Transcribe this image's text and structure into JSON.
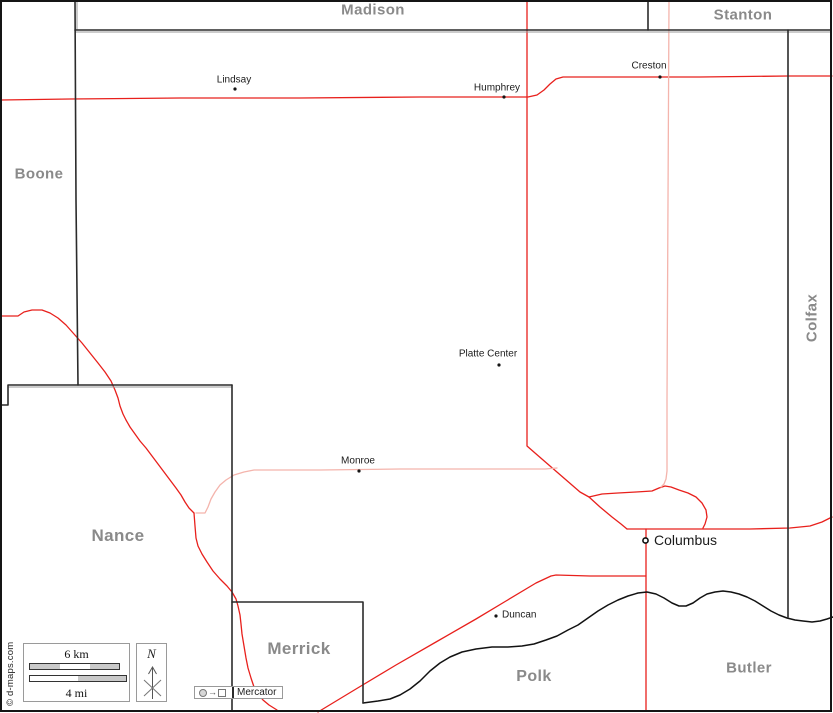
{
  "map": {
    "width": 833,
    "height": 713,
    "colors": {
      "background": "#ffffff",
      "frame": "#151515",
      "boundary": "#2b2b2b",
      "boundary_shadow": "#9a9a9a",
      "road_red": "#e8201c",
      "road_pink": "#f4b4ac",
      "river": "#121212",
      "county_label": "#8a8a8a",
      "town_label": "#1b1b1b"
    }
  },
  "counties": [
    {
      "name": "Madison",
      "pos": [
        373,
        10
      ],
      "size": 15,
      "rotate": false
    },
    {
      "name": "Stanton",
      "pos": [
        743,
        15
      ],
      "size": 15,
      "rotate": false
    },
    {
      "name": "Boone",
      "pos": [
        39,
        174
      ],
      "size": 15,
      "rotate": false
    },
    {
      "name": "Colfax",
      "pos": [
        812,
        318
      ],
      "size": 15,
      "rotate": true
    },
    {
      "name": "Nance",
      "pos": [
        118,
        536
      ],
      "size": 17,
      "rotate": false
    },
    {
      "name": "Merrick",
      "pos": [
        299,
        649
      ],
      "size": 17,
      "rotate": false
    },
    {
      "name": "Polk",
      "pos": [
        534,
        677
      ],
      "size": 16,
      "rotate": false
    },
    {
      "name": "Butler",
      "pos": [
        749,
        668
      ],
      "size": 15,
      "rotate": false
    }
  ],
  "towns": [
    {
      "name": "Lindsay",
      "dot": [
        235,
        89
      ],
      "label": [
        234,
        80
      ],
      "anchor": "center",
      "major": false
    },
    {
      "name": "Humphrey",
      "dot": [
        504,
        97
      ],
      "label": [
        497,
        88
      ],
      "anchor": "center",
      "major": false
    },
    {
      "name": "Creston",
      "dot": [
        660,
        77
      ],
      "label": [
        649,
        66
      ],
      "anchor": "center",
      "major": false
    },
    {
      "name": "Platte Center",
      "dot": [
        499,
        365
      ],
      "label": [
        488,
        354
      ],
      "anchor": "center",
      "major": false
    },
    {
      "name": "Monroe",
      "dot": [
        359,
        471
      ],
      "label": [
        358,
        461
      ],
      "anchor": "center",
      "major": false
    },
    {
      "name": "Duncan",
      "dot": [
        496,
        616
      ],
      "label": [
        502,
        615
      ],
      "anchor": "left",
      "major": false
    },
    {
      "name": "Columbus",
      "dot": [
        645.5,
        540.5
      ],
      "label": [
        654,
        540
      ],
      "anchor": "left",
      "major": true
    }
  ],
  "legend": {
    "scale_km": "6 km",
    "scale_mi": "4 mi",
    "north_label": "N",
    "projection": "Mercator",
    "copyright": "© d-maps.com"
  },
  "geometry": {
    "frame": {
      "x": 1,
      "y": 1,
      "w": 830,
      "h": 710
    },
    "boundaries": [
      {
        "name": "boundary-boone-east",
        "points": [
          [
            75,
            1
          ],
          [
            76,
            200
          ],
          [
            78,
            385
          ]
        ]
      },
      {
        "name": "boundary-platte-north",
        "points": [
          [
            75,
            30
          ],
          [
            831,
            30
          ]
        ]
      },
      {
        "name": "boundary-madison-stanton",
        "points": [
          [
            648,
            1
          ],
          [
            648,
            30
          ]
        ]
      },
      {
        "name": "boundary-colfax-west",
        "points": [
          [
            788,
            30
          ],
          [
            788,
            617
          ]
        ]
      },
      {
        "name": "boundary-nance-north",
        "points": [
          [
            232,
            385
          ],
          [
            8,
            385
          ],
          [
            8,
            405
          ],
          [
            1,
            405
          ]
        ]
      },
      {
        "name": "boundary-nance-east",
        "points": [
          [
            232,
            385
          ],
          [
            232,
            711
          ]
        ]
      },
      {
        "name": "boundary-merrick-box",
        "points": [
          [
            232,
            602
          ],
          [
            363,
            602
          ],
          [
            363,
            703
          ]
        ]
      }
    ],
    "boundary_shadows": [
      {
        "name": "shadow-boone-east",
        "points": [
          [
            77,
            2
          ],
          [
            77,
            29
          ]
        ]
      },
      {
        "name": "shadow-platte-north",
        "points": [
          [
            76,
            32
          ],
          [
            831,
            32
          ]
        ]
      },
      {
        "name": "shadow-nance-north",
        "points": [
          [
            9,
            387
          ],
          [
            232,
            387
          ]
        ]
      }
    ],
    "river": {
      "name": "river",
      "points": [
        [
          363,
          703
        ],
        [
          378,
          701
        ],
        [
          390,
          699
        ],
        [
          400,
          695
        ],
        [
          410,
          689
        ],
        [
          420,
          681
        ],
        [
          430,
          671
        ],
        [
          440,
          663
        ],
        [
          450,
          657
        ],
        [
          462,
          652
        ],
        [
          476,
          649
        ],
        [
          492,
          647
        ],
        [
          508,
          647
        ],
        [
          522,
          646
        ],
        [
          534,
          644
        ],
        [
          546,
          640
        ],
        [
          557,
          636
        ],
        [
          568,
          630
        ],
        [
          578,
          625
        ],
        [
          588,
          618
        ],
        [
          598,
          611
        ],
        [
          608,
          605
        ],
        [
          618,
          600
        ],
        [
          628,
          596
        ],
        [
          638,
          593
        ],
        [
          647,
          592
        ],
        [
          656,
          594
        ],
        [
          664,
          598
        ],
        [
          672,
          603
        ],
        [
          679,
          606
        ],
        [
          686,
          606
        ],
        [
          693,
          603
        ],
        [
          700,
          598
        ],
        [
          707,
          594
        ],
        [
          715,
          592
        ],
        [
          723,
          591
        ],
        [
          731,
          592
        ],
        [
          739,
          594
        ],
        [
          747,
          597
        ],
        [
          755,
          601
        ],
        [
          763,
          606
        ],
        [
          771,
          611
        ],
        [
          779,
          615
        ],
        [
          787,
          618
        ],
        [
          795,
          620
        ],
        [
          803,
          621
        ],
        [
          812,
          622
        ],
        [
          820,
          621
        ],
        [
          827,
          619
        ],
        [
          833,
          617
        ]
      ]
    },
    "roads": [
      {
        "name": "road-north-highway",
        "tone": "red",
        "points": [
          [
            1,
            100
          ],
          [
            70,
            99
          ],
          [
            180,
            98
          ],
          [
            300,
            98
          ],
          [
            420,
            97
          ],
          [
            500,
            97
          ],
          [
            528,
            97
          ],
          [
            537,
            95
          ],
          [
            544,
            90
          ],
          [
            550,
            84
          ],
          [
            556,
            79
          ],
          [
            563,
            77
          ],
          [
            620,
            77
          ],
          [
            700,
            77
          ],
          [
            788,
            76
          ],
          [
            832,
            76
          ]
        ]
      },
      {
        "name": "road-humphrey-columbus",
        "tone": "red",
        "points": [
          [
            527,
            1
          ],
          [
            527,
            150
          ],
          [
            527,
            300
          ],
          [
            527,
            446
          ],
          [
            535,
            453
          ],
          [
            550,
            466
          ],
          [
            565,
            479
          ],
          [
            580,
            492
          ],
          [
            589,
            497
          ],
          [
            600,
            507
          ],
          [
            612,
            517
          ],
          [
            621,
            524
          ],
          [
            627,
            529
          ]
        ]
      },
      {
        "name": "road-loop-north-columbus",
        "tone": "red",
        "points": [
          [
            589,
            497
          ],
          [
            602,
            494
          ],
          [
            618,
            493
          ],
          [
            636,
            492
          ],
          [
            652,
            491
          ],
          [
            659,
            488
          ],
          [
            665,
            486
          ],
          [
            671,
            487
          ],
          [
            679,
            490
          ],
          [
            688,
            493
          ],
          [
            696,
            497
          ],
          [
            702,
            503
          ],
          [
            706,
            510
          ],
          [
            707,
            517
          ],
          [
            705,
            524
          ],
          [
            703,
            528
          ]
        ]
      },
      {
        "name": "road-columbus-east",
        "tone": "red",
        "points": [
          [
            627,
            529
          ],
          [
            665,
            529
          ],
          [
            705,
            529
          ],
          [
            750,
            529
          ],
          [
            790,
            528
          ],
          [
            810,
            526
          ],
          [
            822,
            522
          ],
          [
            832,
            517
          ]
        ]
      },
      {
        "name": "road-columbus-south",
        "tone": "red",
        "points": [
          [
            646,
            529
          ],
          [
            646,
            570
          ],
          [
            646,
            592
          ],
          [
            646,
            650
          ],
          [
            646,
            711
          ]
        ]
      },
      {
        "name": "road-duncan",
        "tone": "red",
        "points": [
          [
            318,
            712
          ],
          [
            356,
            689
          ],
          [
            396,
            665
          ],
          [
            436,
            642
          ],
          [
            476,
            619
          ],
          [
            506,
            601
          ],
          [
            536,
            583
          ],
          [
            551,
            576
          ],
          [
            556,
            575
          ],
          [
            590,
            576
          ],
          [
            620,
            576
          ],
          [
            646,
            576
          ]
        ]
      },
      {
        "name": "road-northwest",
        "tone": "red",
        "points": [
          [
            0,
            316
          ],
          [
            18,
            316
          ],
          [
            24,
            312
          ],
          [
            32,
            310
          ],
          [
            42,
            310
          ],
          [
            50,
            313
          ],
          [
            58,
            318
          ],
          [
            66,
            325
          ],
          [
            74,
            334
          ],
          [
            82,
            343
          ],
          [
            90,
            353
          ],
          [
            98,
            363
          ],
          [
            105,
            372
          ],
          [
            111,
            381
          ],
          [
            115,
            390
          ],
          [
            118,
            398
          ],
          [
            120,
            406
          ],
          [
            123,
            414
          ],
          [
            126,
            420
          ],
          [
            130,
            427
          ],
          [
            135,
            434
          ],
          [
            140,
            441
          ],
          [
            146,
            448
          ],
          [
            152,
            456
          ],
          [
            158,
            464
          ],
          [
            164,
            472
          ],
          [
            170,
            480
          ],
          [
            176,
            488
          ],
          [
            181,
            495
          ],
          [
            185,
            502
          ],
          [
            189,
            508
          ],
          [
            194,
            513
          ]
        ]
      },
      {
        "name": "road-south-nance",
        "tone": "red",
        "points": [
          [
            194,
            513
          ],
          [
            195,
            526
          ],
          [
            196,
            538
          ],
          [
            198,
            546
          ],
          [
            202,
            554
          ],
          [
            207,
            562
          ],
          [
            213,
            571
          ],
          [
            220,
            579
          ],
          [
            227,
            586
          ],
          [
            232,
            592
          ],
          [
            236,
            599
          ],
          [
            238,
            606
          ],
          [
            240,
            615
          ],
          [
            241,
            624
          ],
          [
            242,
            634
          ],
          [
            244,
            646
          ],
          [
            246,
            658
          ],
          [
            248,
            668
          ],
          [
            251,
            678
          ],
          [
            254,
            687
          ],
          [
            258,
            694
          ],
          [
            263,
            700
          ],
          [
            269,
            705
          ],
          [
            277,
            710
          ]
        ]
      },
      {
        "name": "road-creston-vertical",
        "tone": "pink",
        "points": [
          [
            669,
            1
          ],
          [
            668,
            200
          ],
          [
            667,
            400
          ],
          [
            667,
            460
          ],
          [
            667,
            471
          ],
          [
            666,
            479
          ],
          [
            664,
            484
          ],
          [
            661,
            487
          ]
        ]
      },
      {
        "name": "road-monroe",
        "tone": "pink",
        "points": [
          [
            196,
            513
          ],
          [
            205,
            513
          ],
          [
            208,
            507
          ],
          [
            211,
            499
          ],
          [
            215,
            492
          ],
          [
            220,
            485
          ],
          [
            226,
            480
          ],
          [
            234,
            475
          ],
          [
            244,
            472
          ],
          [
            254,
            470
          ],
          [
            320,
            470
          ],
          [
            400,
            469
          ],
          [
            480,
            469
          ],
          [
            530,
            469
          ],
          [
            545,
            469
          ],
          [
            557,
            468
          ]
        ]
      }
    ]
  }
}
